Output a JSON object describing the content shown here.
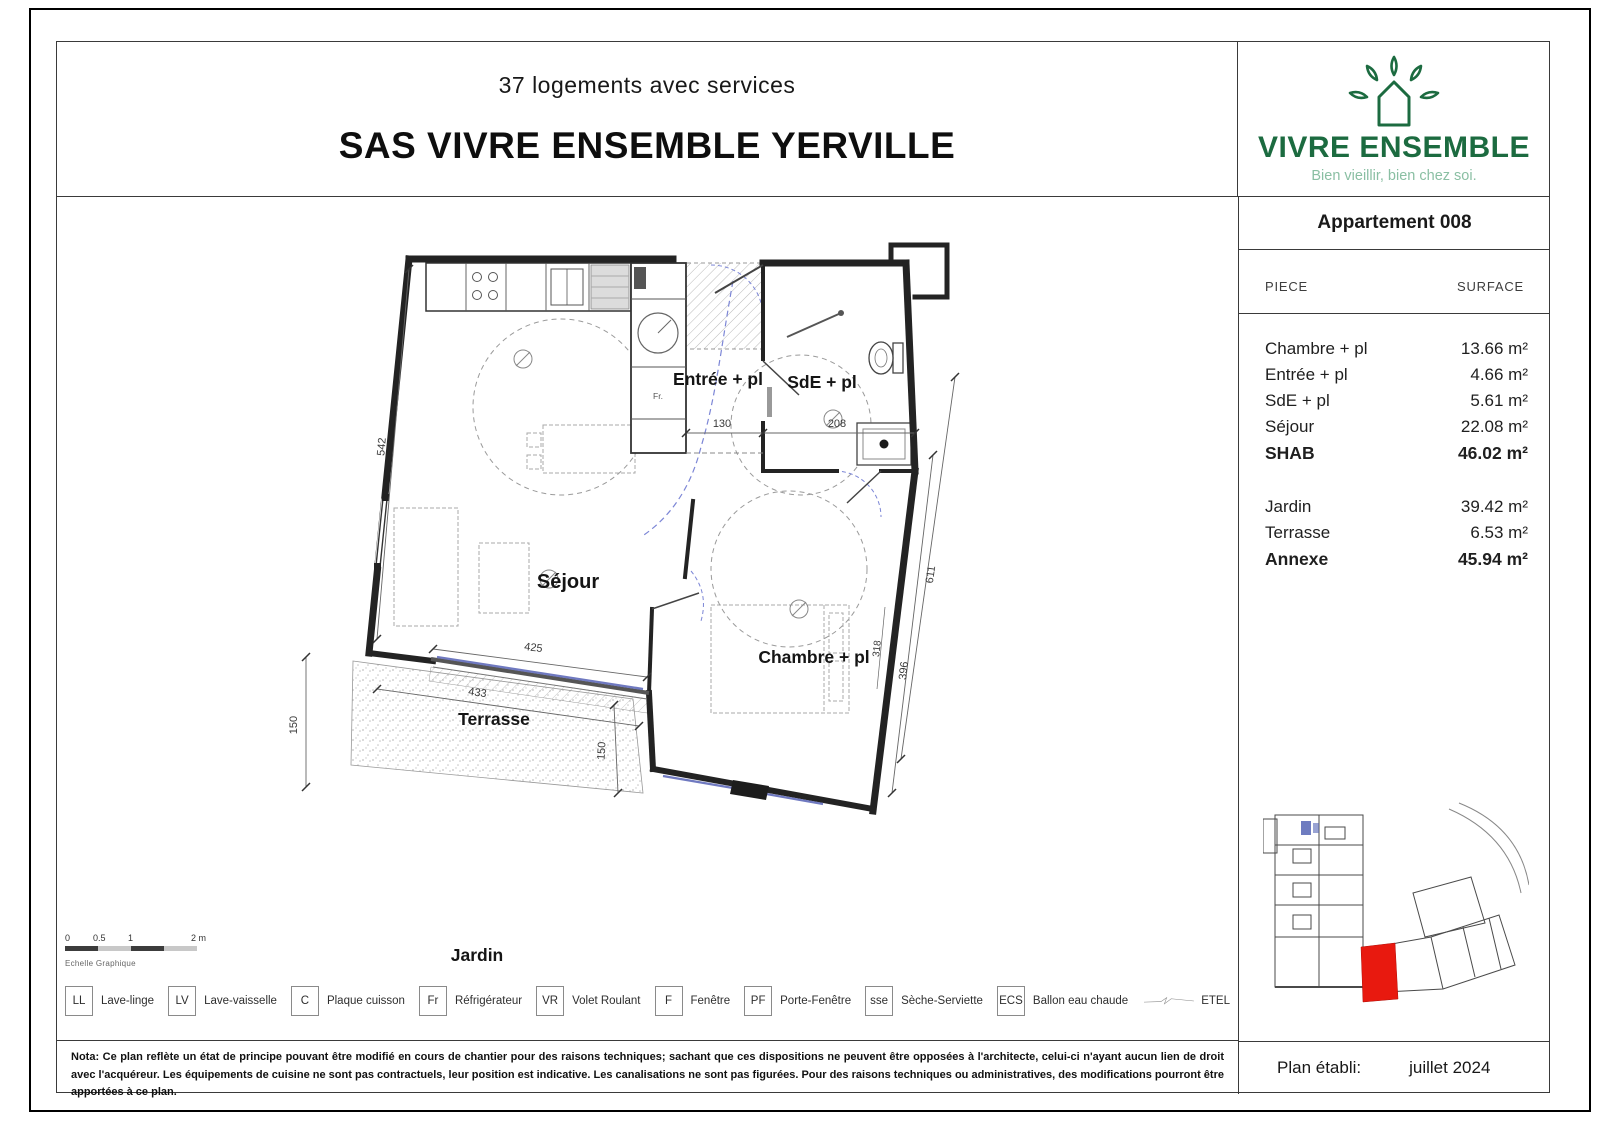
{
  "header": {
    "subtitle": "37 logements avec services",
    "title": "SAS VIVRE ENSEMBLE YERVILLE"
  },
  "logo": {
    "brand": "VIVRE ENSEMBLE",
    "tagline": "Bien vieillir, bien chez soi.",
    "color_dark": "#1c6b40",
    "color_light": "#8abfa3"
  },
  "apartment": {
    "title": "Appartement 008",
    "columns": {
      "piece": "PIECE",
      "surface": "SURFACE"
    },
    "rows": [
      {
        "piece": "Chambre + pl",
        "surface": "13.66 m²"
      },
      {
        "piece": "Entrée + pl",
        "surface": "4.66 m²"
      },
      {
        "piece": "SdE + pl",
        "surface": "5.61 m²"
      },
      {
        "piece": "Séjour",
        "surface": "22.08 m²"
      },
      {
        "piece": "SHAB",
        "surface": "46.02 m²"
      },
      {
        "piece": "Jardin",
        "surface": "39.42 m²"
      },
      {
        "piece": "Terrasse",
        "surface": "6.53 m²"
      },
      {
        "piece": "Annexe",
        "surface": "45.94 m²"
      }
    ],
    "established_label": "Plan établi:",
    "established_date": "juillet 2024"
  },
  "plan": {
    "rooms": {
      "sejour": "Séjour",
      "entree": "Entrée + pl",
      "sde": "SdE + pl",
      "chambre": "Chambre + pl",
      "terrasse": "Terrasse",
      "jardin": "Jardin",
      "fridge": "Fr."
    },
    "dims": {
      "d542": "542",
      "d130": "130",
      "d208": "208",
      "d425": "425",
      "d433": "433",
      "d150a": "150",
      "d150b": "150",
      "d611": "611",
      "d396": "396",
      "d318": "318"
    },
    "window_color": "#6f79c0",
    "door_swing_color": "#7c86d6"
  },
  "scalebar": {
    "ticks": [
      "0",
      "0.5",
      "1",
      "2 m"
    ],
    "caption": "Echelle Graphique"
  },
  "legend": {
    "items": [
      {
        "abbr": "LL",
        "label": "Lave-linge"
      },
      {
        "abbr": "LV",
        "label": "Lave-vaisselle"
      },
      {
        "abbr": "C",
        "label": "Plaque cuisson"
      },
      {
        "abbr": "Fr",
        "label": "Réfrigérateur"
      },
      {
        "abbr": "VR",
        "label": "Volet Roulant"
      },
      {
        "abbr": "F",
        "label": "Fenêtre"
      },
      {
        "abbr": "PF",
        "label": "Porte-Fenêtre"
      },
      {
        "abbr": "sse",
        "label": "Sèche-Serviette"
      },
      {
        "abbr": "ECS",
        "label": "Ballon eau chaude"
      }
    ],
    "etel": "ETEL"
  },
  "keyplan": {
    "highlight_color": "#e8190f"
  },
  "nota": "Nota: Ce plan reflète un état de principe pouvant être modifié en cours de chantier pour des raisons techniques; sachant que ces dispositions ne peuvent être opposées à l'architecte, celui-ci n'ayant aucun lien de droit avec l'acquéreur. Les équipements de cuisine ne sont pas contractuels, leur position est indicative. Les canalisations ne sont pas figurées. Pour des raisons techniques ou administratives, des modifications pourront être apportées à ce plan."
}
